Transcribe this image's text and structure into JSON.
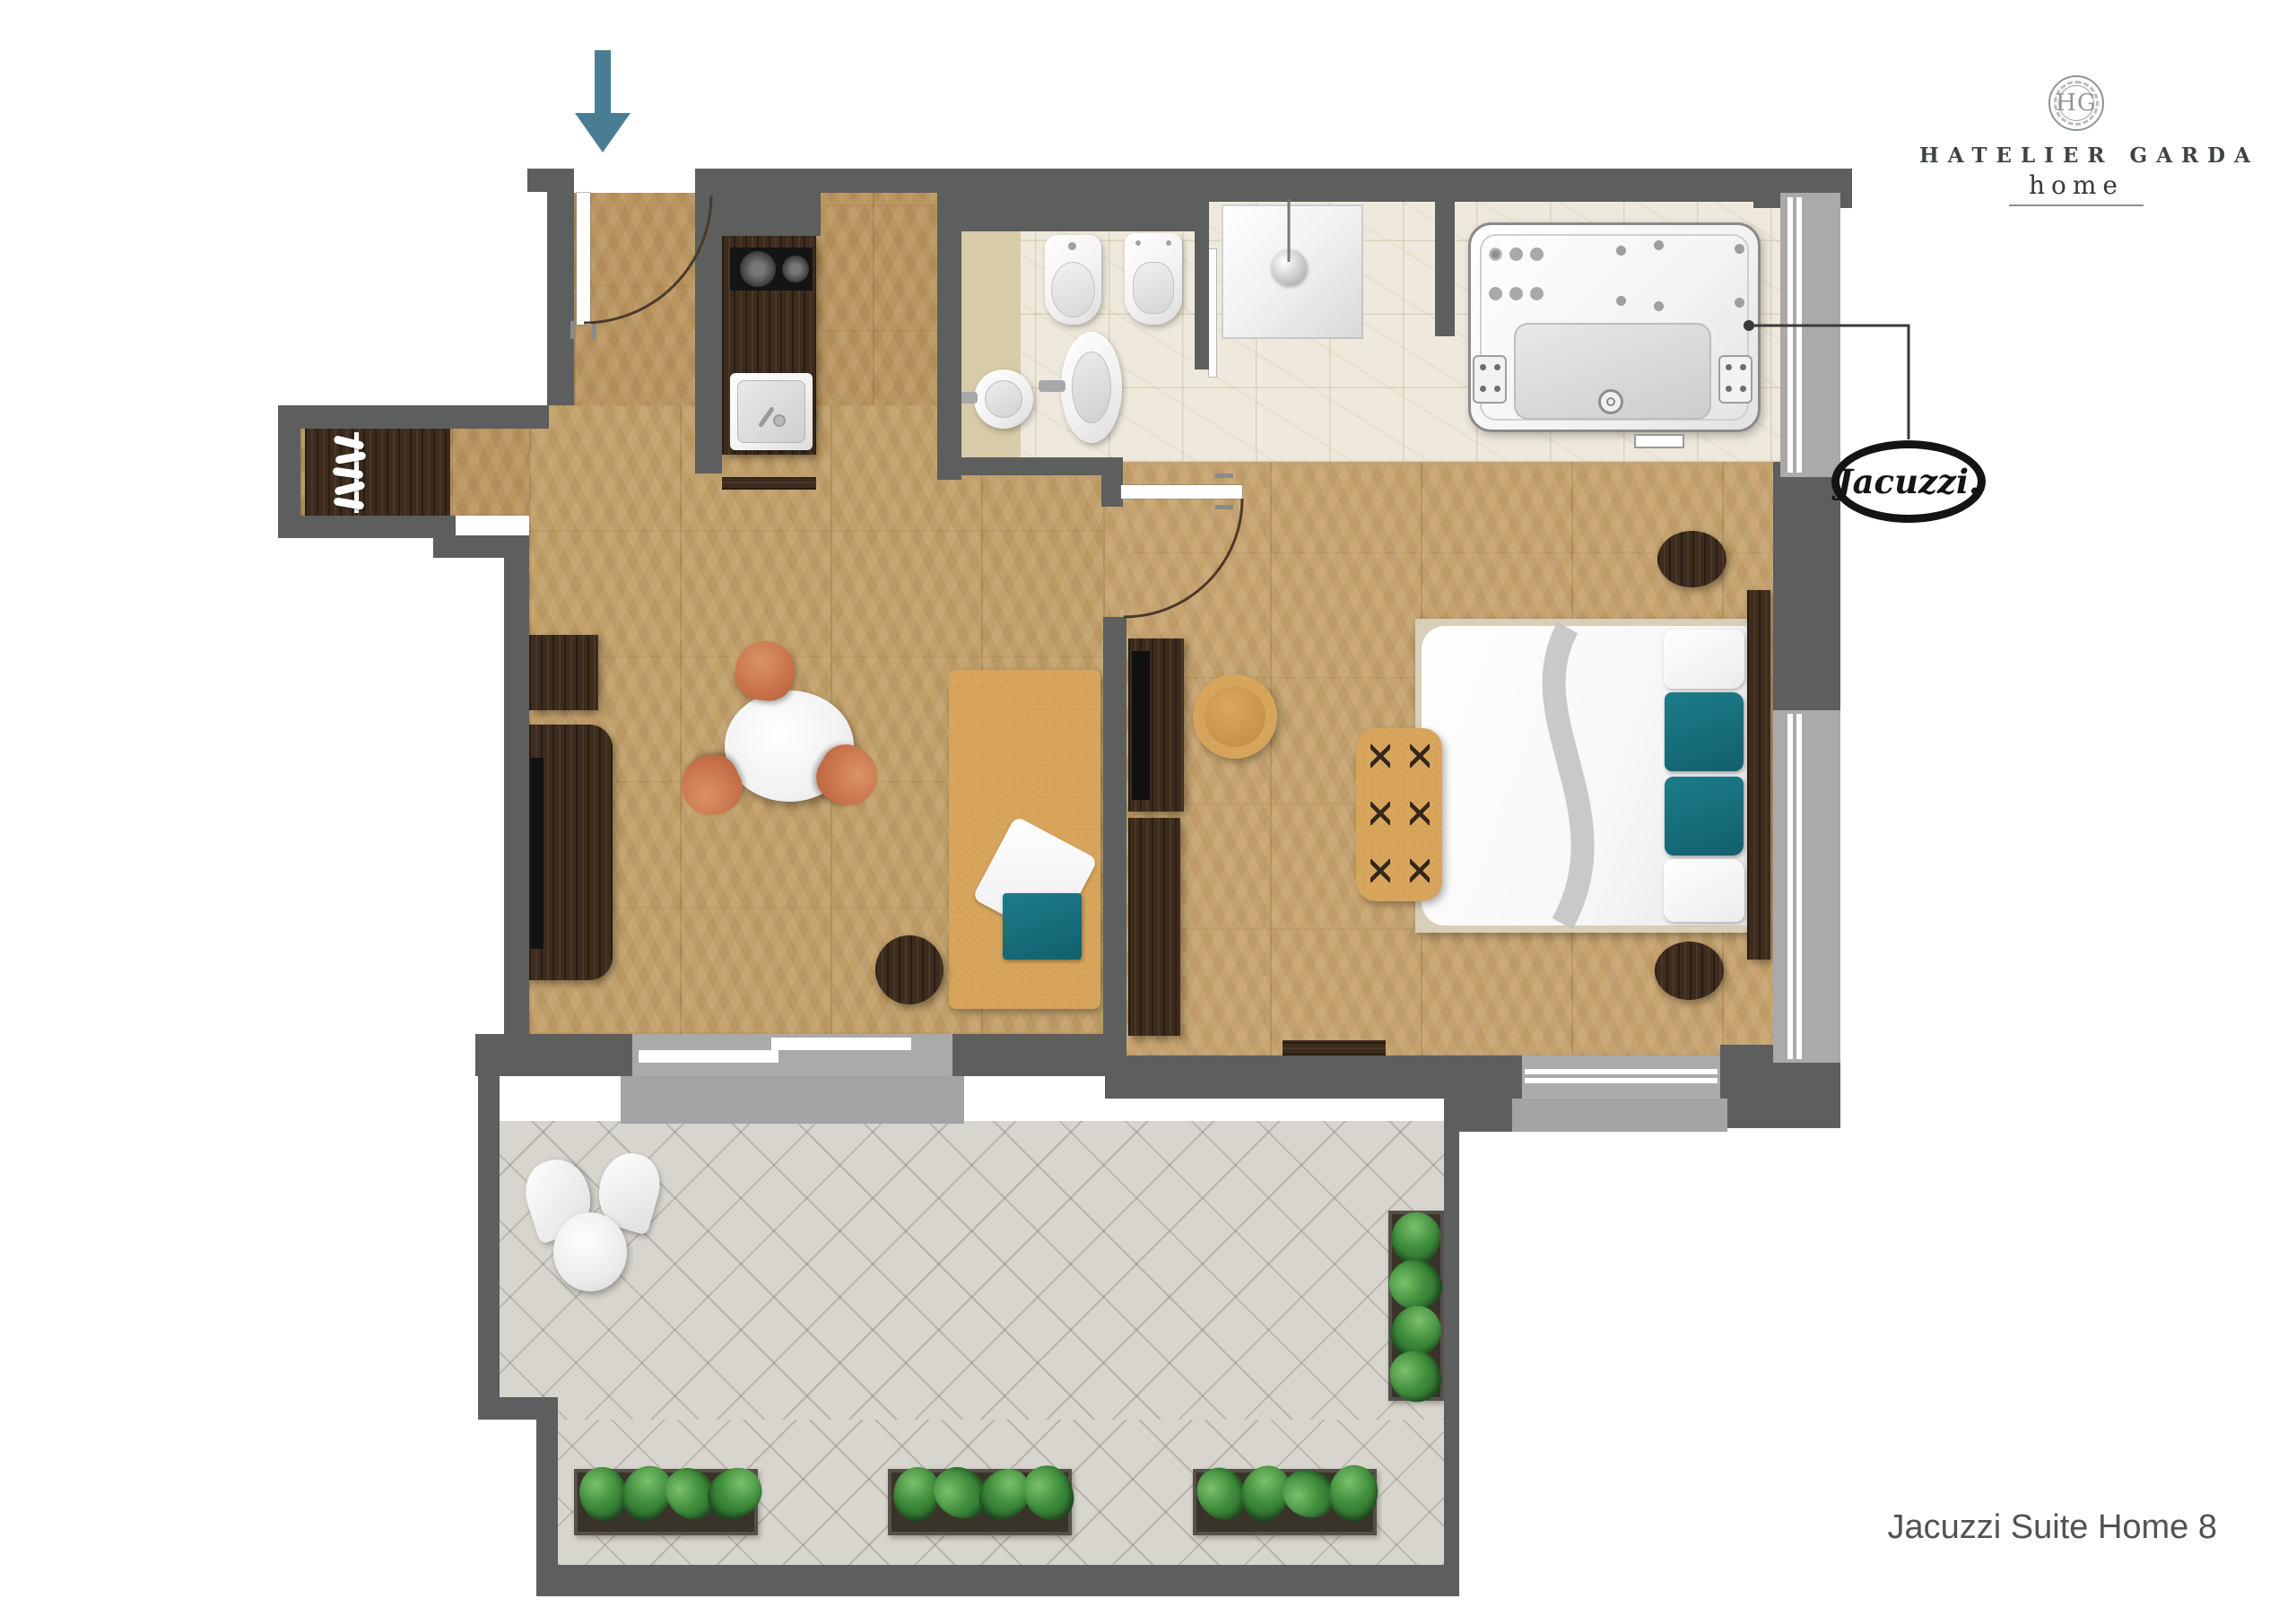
{
  "branding": {
    "monogram": "HG",
    "name": "HATELIER GARDA",
    "sub": "home"
  },
  "brand_badge": {
    "label": "Jacuzzi."
  },
  "footer": {
    "plan_title": "Jacuzzi Suite Home 8"
  },
  "icons": {
    "entrance": "entrance-arrow-down-icon",
    "callout": "jacuzzi-callout-line"
  },
  "colors": {
    "wall": "#5d5e5e",
    "window_sill": "#a2a4a3",
    "wood_floor": "#c2a069",
    "dark_wood": "#3d2c1d",
    "terracotta_chair": "#c8714a",
    "leather_tan": "#d7a45c",
    "teal_accent": "#156d7b",
    "marble_tile": "#eee9dc",
    "terrace_tile": "#d8d5ce",
    "plant_green": "#2e7d32",
    "arrow_blue": "#4a7d93",
    "logo_black": "#141414",
    "title_gray": "#4f5354"
  }
}
